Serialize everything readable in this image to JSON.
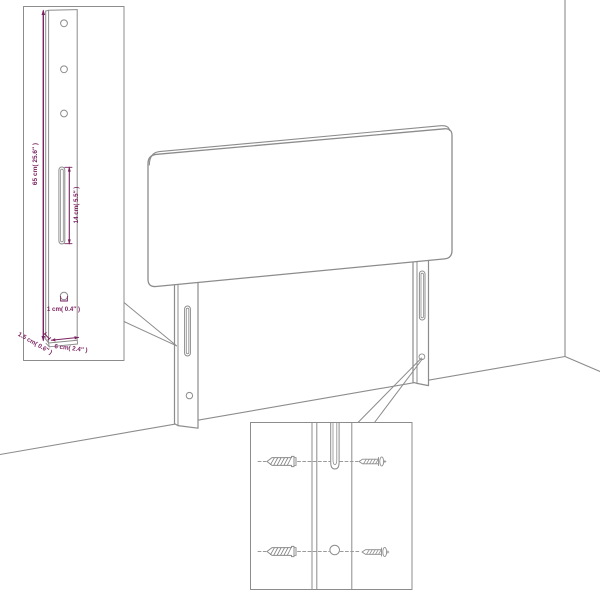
{
  "diagram": {
    "type": "assembly-dimension-diagram",
    "labels": {
      "post_height": "65 cm( 25.6″ )",
      "slot_length": "14 cm( 5.5″ )",
      "hole_size": "1 cm( 0.4″ )",
      "post_depth": "1.5 cm( 0.6″ )",
      "post_width": "6 cm( 2.4″ )"
    },
    "icons": {
      "wall_plug": "wall-plug-icon",
      "screw": "screw-icon",
      "slot": "keyhole-slot",
      "hole": "screw-hole"
    },
    "colors": {
      "outline_gray": "#8c8c8c",
      "dimension_magenta": "#7a2260",
      "background": "#ffffff"
    }
  }
}
